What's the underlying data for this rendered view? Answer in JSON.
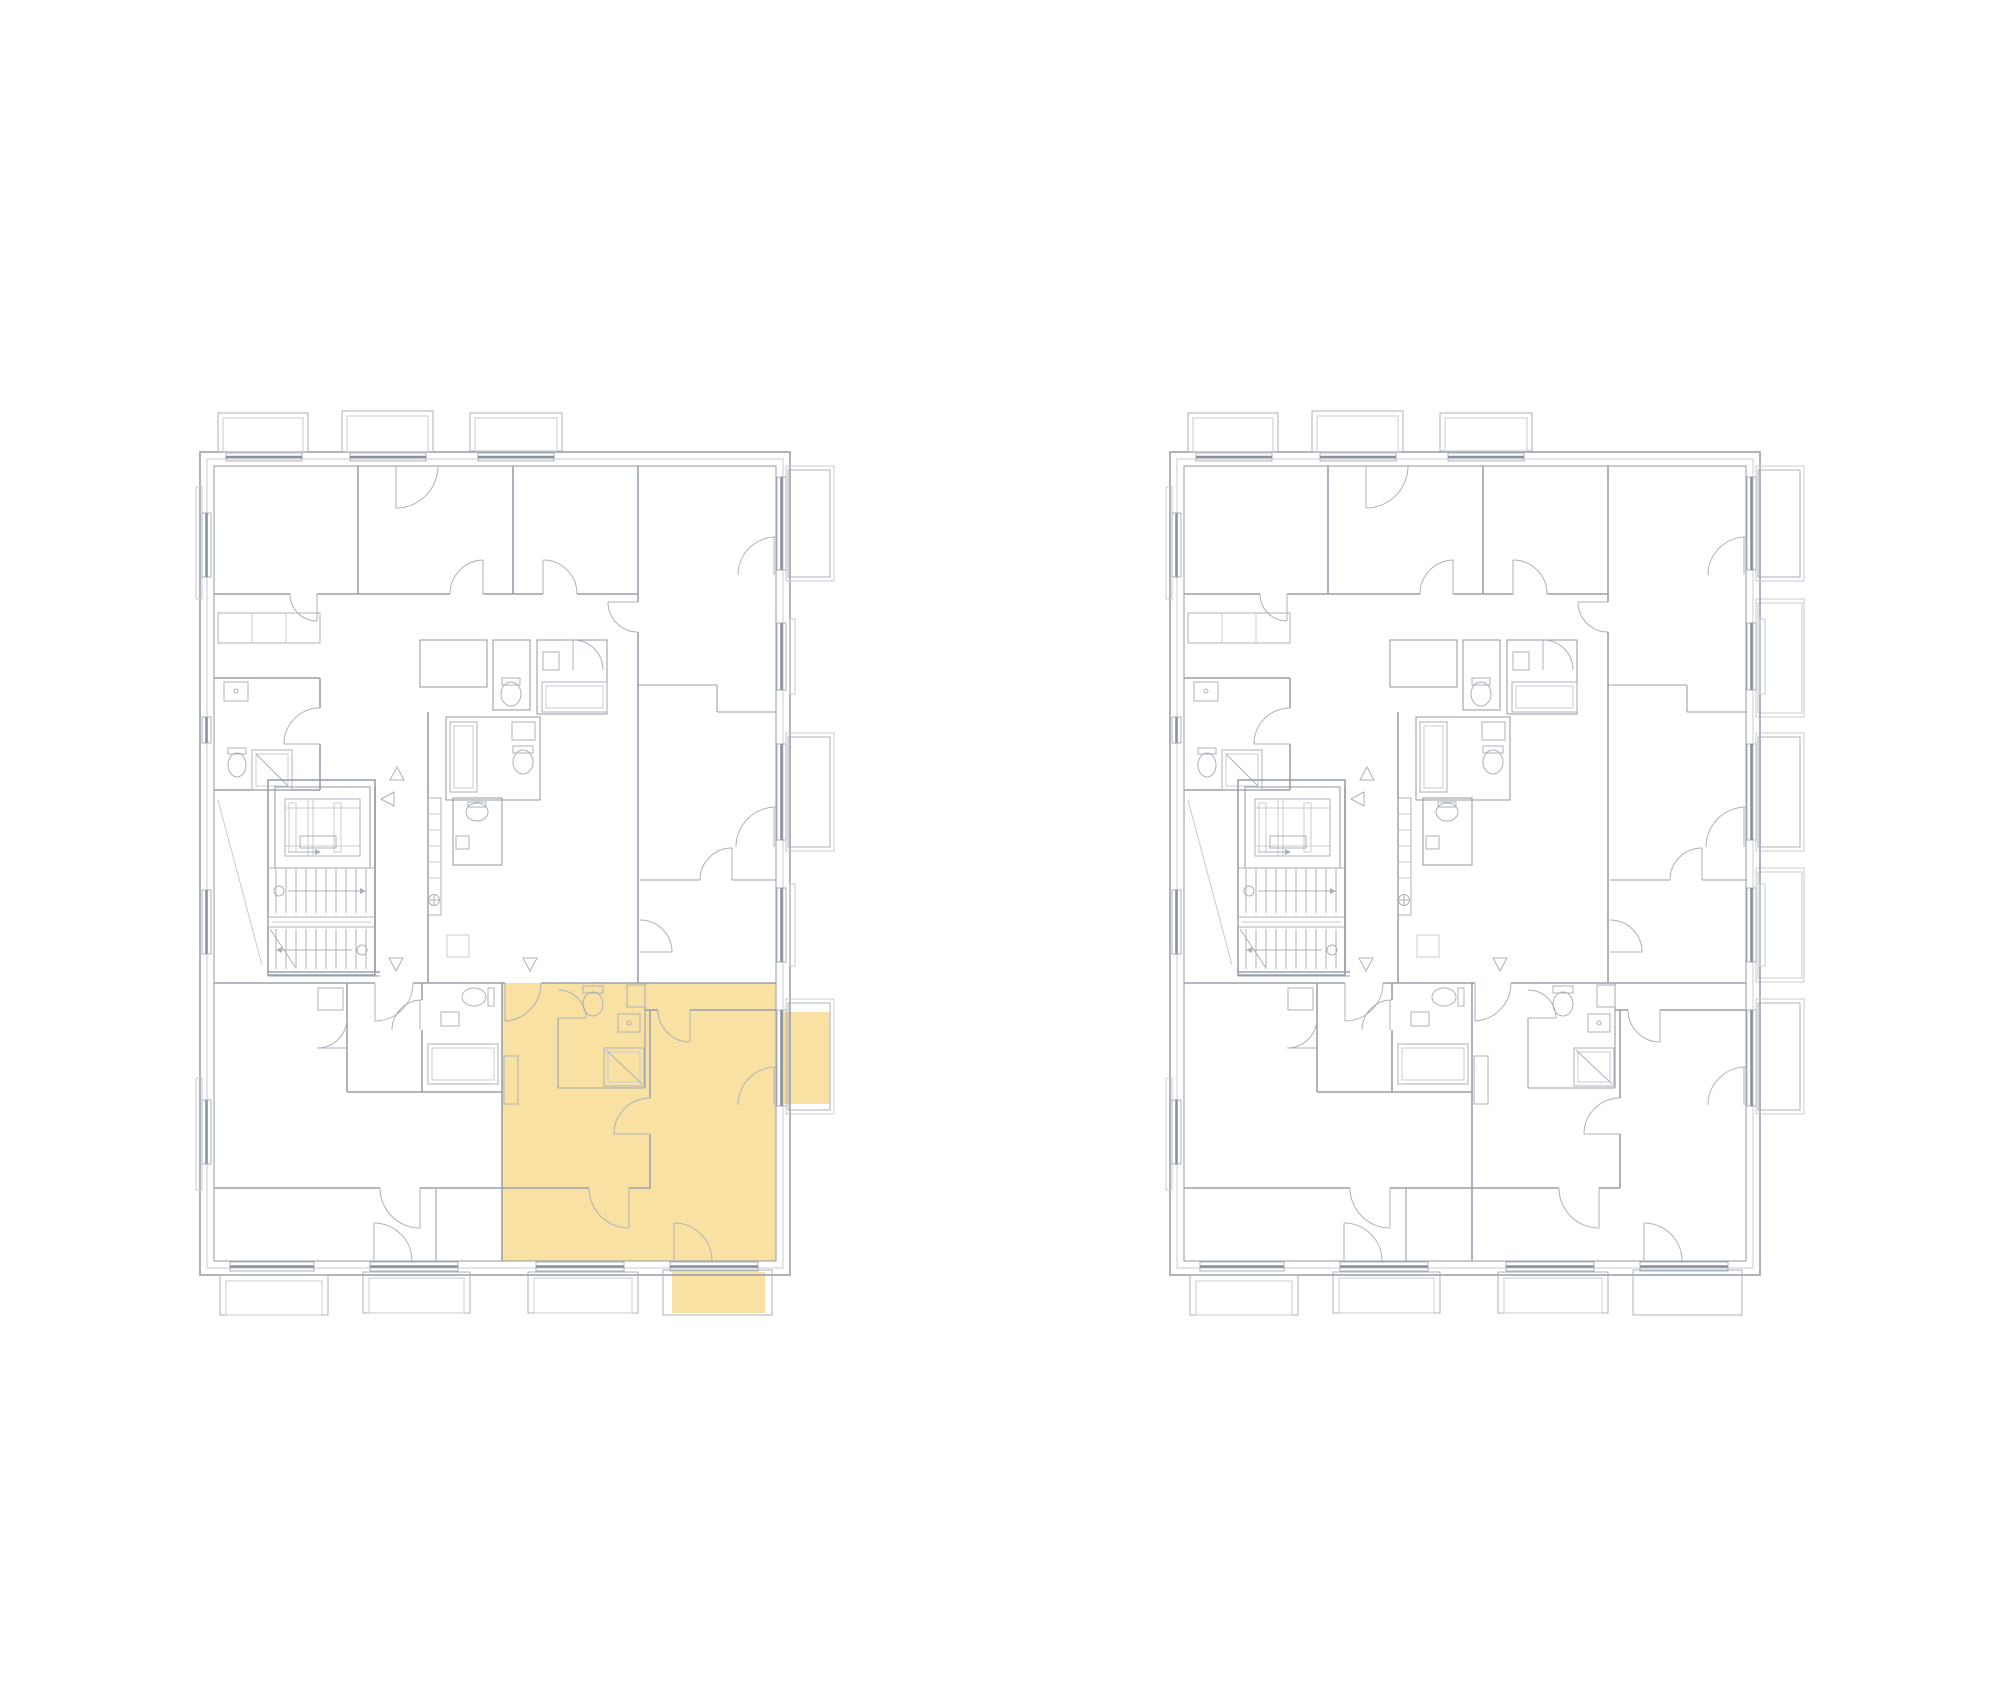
{
  "canvas": {
    "width": 2000,
    "height": 1700,
    "background": "#ffffff"
  },
  "palette": {
    "wall_line": "#9aa1ab",
    "detail_line": "#abb1bb",
    "light_line": "#c7ccd3",
    "window_sill_line": "#8a919c",
    "highlight_fill": "#F9E1A3"
  },
  "plans": [
    {
      "id": "left-plan",
      "position": "left",
      "has_highlighted_unit": true,
      "highlighted_unit": {
        "location": "bottom-right",
        "parts": [
          "apartment-interior",
          "side-balcony",
          "bottom-balcony"
        ],
        "fill": "#F9E1A3"
      }
    },
    {
      "id": "right-plan",
      "position": "right",
      "has_highlighted_unit": false
    }
  ],
  "drawing": {
    "type": "architectural-floor-plan",
    "features": [
      "apartments",
      "elevator",
      "staircase",
      "bathrooms",
      "balconies",
      "door-swings",
      "windows",
      "direction-arrows"
    ],
    "top_balconies": 3,
    "bottom_balconies": 4,
    "right_side_balconies": 3
  }
}
